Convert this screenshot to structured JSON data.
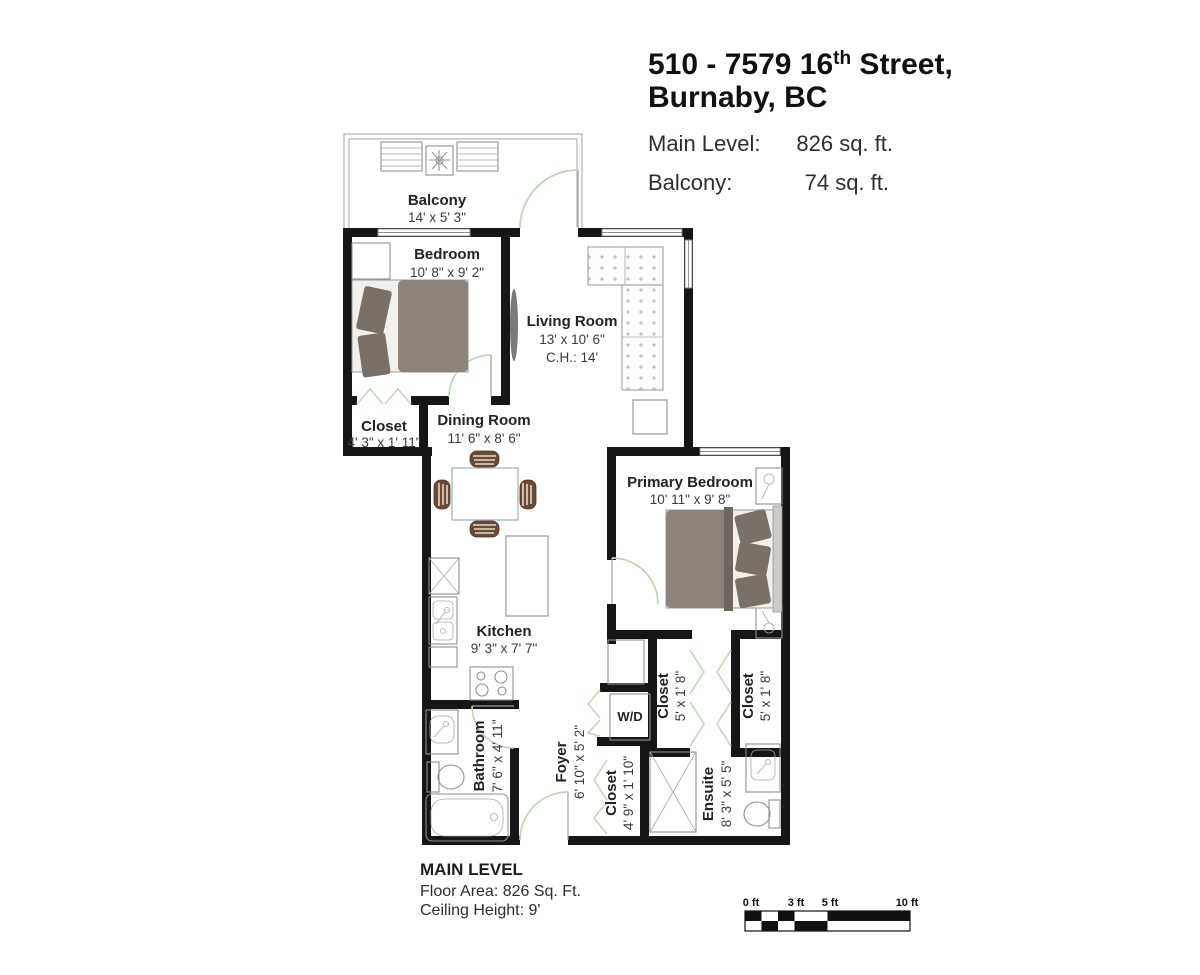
{
  "header": {
    "address_line1_part1": "510 - 7579 16",
    "address_line1_sup": "th",
    "address_line1_part2": " Street,",
    "address_line2": "Burnaby, BC",
    "area_rows": [
      {
        "label": "Main Level:",
        "value": "826 sq. ft."
      },
      {
        "label": "Balcony:",
        "value": "74 sq. ft."
      }
    ]
  },
  "rooms": {
    "balcony": {
      "name": "Balcony",
      "dims": "14' x 5' 3\""
    },
    "bedroom": {
      "name": "Bedroom",
      "dims": "10' 8\" x 9' 2\""
    },
    "living_room": {
      "name": "Living Room",
      "dims": "13' x 10' 6\"",
      "ceiling": "C.H.: 14'"
    },
    "bedroom_closet": {
      "name": "Closet",
      "dims": "4' 3\" x 1' 11\""
    },
    "dining_room": {
      "name": "Dining Room",
      "dims": "11' 6\" x 8' 6\""
    },
    "primary_bedroom": {
      "name": "Primary Bedroom",
      "dims": "10' 11\" x 9' 8\""
    },
    "kitchen": {
      "name": "Kitchen",
      "dims": "9' 3\" x 7' 7\""
    },
    "washer_dryer": {
      "name": "W/D"
    },
    "hall_closet_left": {
      "name": "Closet",
      "dims": "5' x 1' 8\""
    },
    "hall_closet_right": {
      "name": "Closet",
      "dims": "5' x 1' 8\""
    },
    "bathroom": {
      "name": "Bathroom",
      "dims": "7' 6\" x 4' 11\""
    },
    "foyer": {
      "name": "Foyer",
      "dims": "6' 10\" x 5' 2\""
    },
    "foyer_closet": {
      "name": "Closet",
      "dims": "4' 9\" x 1' 10\""
    },
    "ensuite": {
      "name": "Ensuite",
      "dims": "8' 3\" x 5' 5\""
    }
  },
  "footer": {
    "level_title": "MAIN LEVEL",
    "floor_area": "Floor Area: 826 Sq. Ft.",
    "ceiling_height": "Ceiling Height: 9'"
  },
  "scale_bar": {
    "ticks": [
      "0 ft",
      "3 ft",
      "5 ft",
      "10 ft"
    ]
  },
  "colors": {
    "wall": "#161616",
    "door_swing": "#b9d7b1",
    "bed_fill": "#8e8378",
    "pillow_fill": "#7b7065",
    "chair_fill": "#6b4b35",
    "text": "#232323"
  }
}
